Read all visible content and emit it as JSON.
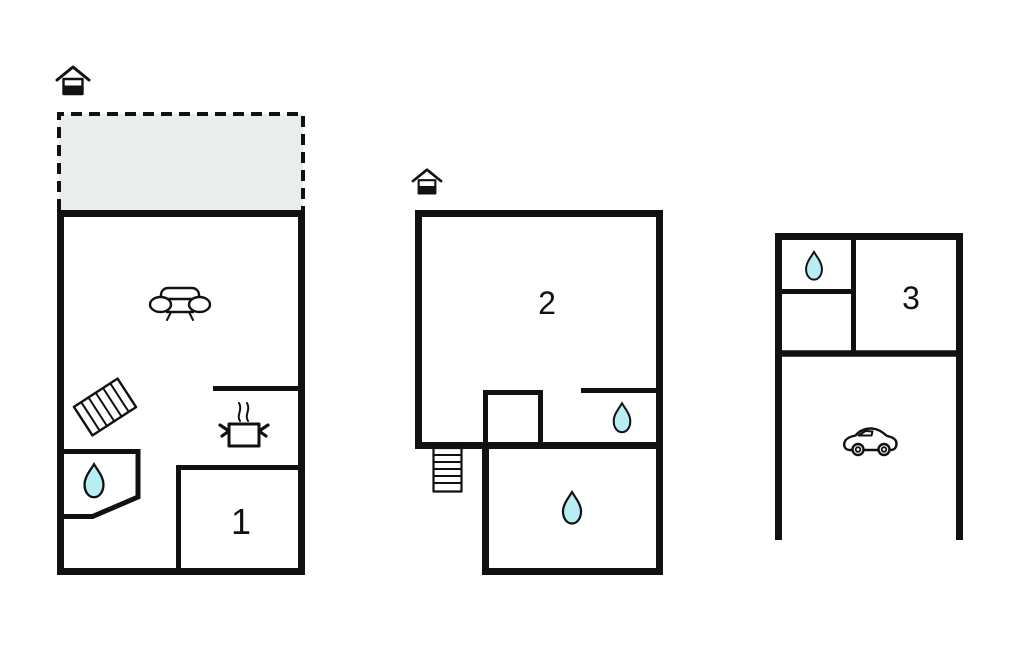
{
  "diagram_type": "vacation-home-floor-plan",
  "colors": {
    "wall": "#111111",
    "water_drop": "#b9edf4",
    "terrace": "#e9eeec",
    "background": "#ffffff"
  },
  "plans": {
    "ground_floor": {
      "room_label": "1",
      "icons": [
        "house-entrance-icon",
        "terrace-dashed-area",
        "sofa-icon",
        "rug-icon",
        "cooking-pot-icon",
        "water-drop-icon"
      ]
    },
    "upper_floor": {
      "room_label": "2",
      "icons": [
        "house-entrance-icon",
        "stairs-icon",
        "water-drop-icon",
        "water-drop-icon"
      ]
    },
    "annex": {
      "room_label": "3",
      "icons": [
        "water-drop-icon",
        "car-icon"
      ]
    }
  }
}
